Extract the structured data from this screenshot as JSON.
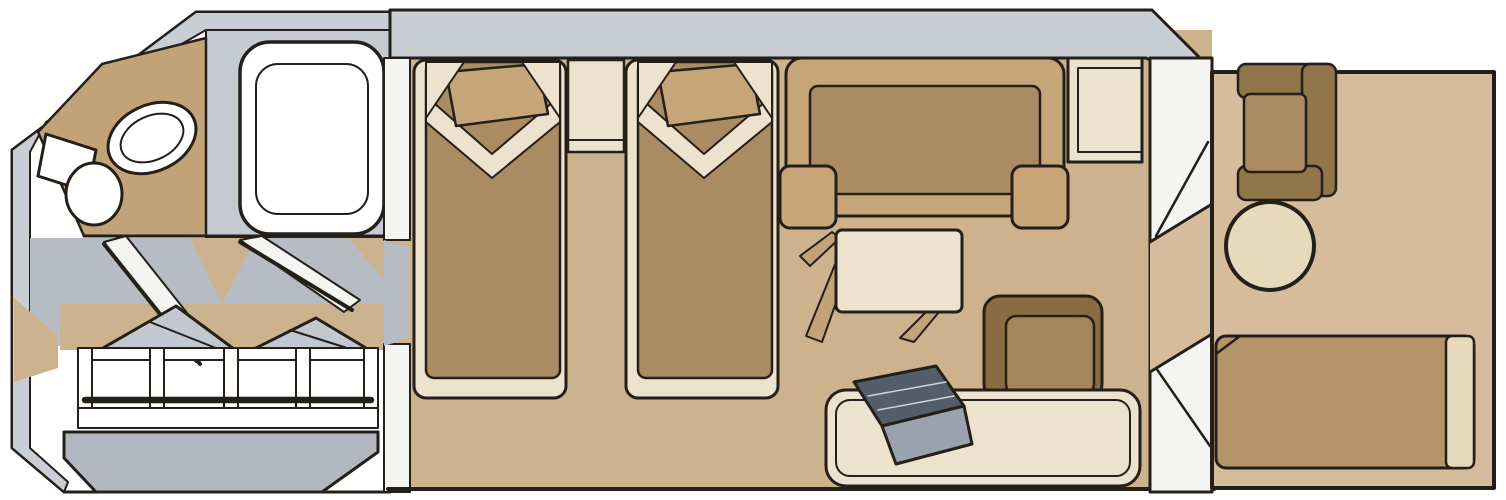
{
  "meta": {
    "title": "Balcony stateroom floor plan",
    "style": "hand-drawn isometric cabin floor plan, no text labels visible"
  },
  "rooms": [
    {
      "id": "bathroom",
      "items": [
        "vanity-counter",
        "sink",
        "toilet",
        "bathtub"
      ]
    },
    {
      "id": "entry-hall",
      "items": [
        "entry-door-swing",
        "bathroom-door-swing",
        "open-wardrobe-closets",
        "closet-platform"
      ]
    },
    {
      "id": "main-cabin",
      "items": [
        "twin-bed-left",
        "twin-bed-right",
        "nightstand",
        "sofa",
        "coffee-table",
        "ottoman-stool",
        "desk",
        "bench-daybed",
        "folded-recliner"
      ]
    },
    {
      "id": "balcony",
      "items": [
        "balcony-chair",
        "round-table",
        "sun-lounger",
        "sliding-glass-door"
      ]
    }
  ],
  "colors": {
    "white": "#ffffff",
    "leaf_white": "#f4f4f2",
    "wall_gray": "#c9cdd4",
    "tub_surround_gray": "#c5c9d1",
    "corridor_gray": "#b7bbc4",
    "closet_gray": "#c3c7cf",
    "platform_gray": "#b3b7c0",
    "cabin_floor": "#cdb28e",
    "balcony_floor": "#d4bc9c",
    "furniture_brown": "#ab8c62",
    "frame_cream": "#ece2cd",
    "pillow_tan": "#c6a679",
    "counter_tan": "#c2a277",
    "stool_dark": "#8a6c44",
    "stool_top": "#a5865c",
    "chair_dark": "#91754b",
    "lounger_brown": "#b6946a",
    "table_cream": "#e7d9bc",
    "slate_dark": "#545e6b",
    "slate_light": "#9aa2ae"
  }
}
